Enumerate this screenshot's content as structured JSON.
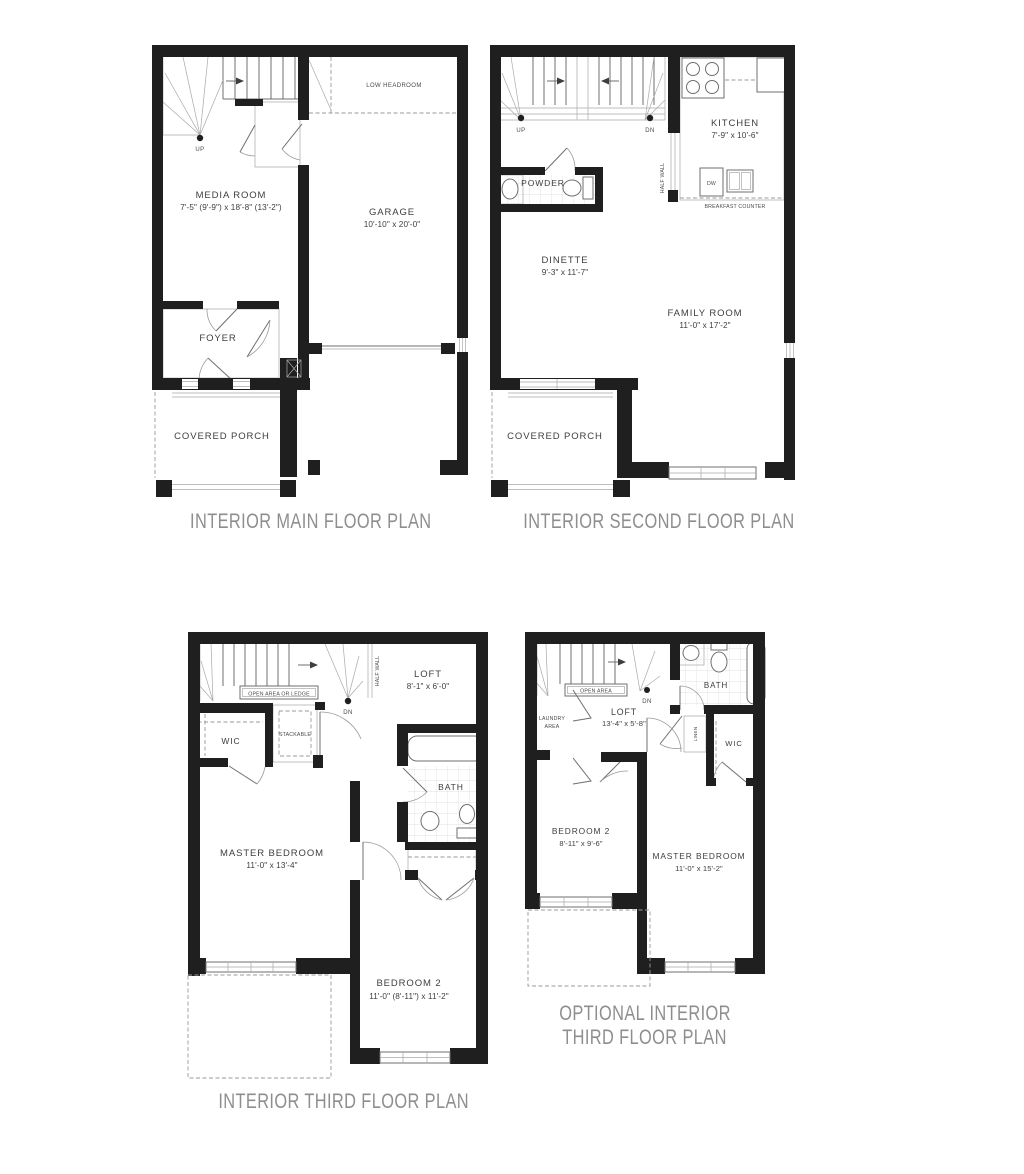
{
  "colors": {
    "wall": "#1f1f1f",
    "thin_line": "#6f6f6f",
    "tile": "#d8d8d8",
    "caption": "#8e8e8e",
    "label": "#3e3e3e"
  },
  "plans": {
    "main": {
      "caption": "INTERIOR MAIN FLOOR PLAN",
      "media_room_name": "MEDIA ROOM",
      "media_room_dims": "7'-5\" (9'-9\") x 18'-8\" (13'-2\")",
      "garage_name": "GARAGE",
      "garage_dims": "10'-10\" x 20'-0\"",
      "foyer_name": "FOYER",
      "porch_name": "COVERED PORCH",
      "low_headroom": "LOW HEADROOM",
      "up": "UP"
    },
    "second": {
      "caption": "INTERIOR SECOND FLOOR PLAN",
      "kitchen_name": "KITCHEN",
      "kitchen_dims": "7'-9\" x 10'-6\"",
      "powder_name": "POWDER",
      "dinette_name": "DINETTE",
      "dinette_dims": "9'-3\" x 11'-7\"",
      "family_room_name": "FAMILY ROOM",
      "family_room_dims": "11'-0\" x 17'-2\"",
      "porch_name": "COVERED PORCH",
      "half_wall": "HALF WALL",
      "dw": "DW",
      "breakfast_counter": "BREAKFAST COUNTER",
      "up": "UP",
      "dn": "DN"
    },
    "third": {
      "caption": "INTERIOR THIRD FLOOR PLAN",
      "loft_name": "LOFT",
      "loft_dims": "8'-1\" x 6'-0\"",
      "wic_name": "WIC",
      "stackable": "STACKABLE",
      "bath_name": "BATH",
      "master_name": "MASTER BEDROOM",
      "master_dims": "11'-0\" x 13'-4\"",
      "bedroom2_name": "BEDROOM 2",
      "bedroom2_dims": "11'-0\" (8'-11\") x 11'-2\"",
      "open_area": "OPEN AREA OR LEDGE",
      "half_wall": "HALF WALL",
      "dn": "DN"
    },
    "optional_third": {
      "caption_line1": "OPTIONAL INTERIOR",
      "caption_line2": "THIRD FLOOR PLAN",
      "loft_name": "LOFT",
      "loft_dims": "13'-4\" x 5'-8\"",
      "bath_name": "BATH",
      "wic_name": "WIC",
      "linen": "LINEN",
      "laundry_line1": "LAUNDRY",
      "laundry_line2": "AREA",
      "open_area": "OPEN AREA",
      "dn": "DN",
      "bedroom2_name": "BEDROOM 2",
      "bedroom2_dims": "8'-11\" x 9'-6\"",
      "master_name": "MASTER BEDROOM",
      "master_dims": "11'-0\" x 15'-2\""
    }
  }
}
